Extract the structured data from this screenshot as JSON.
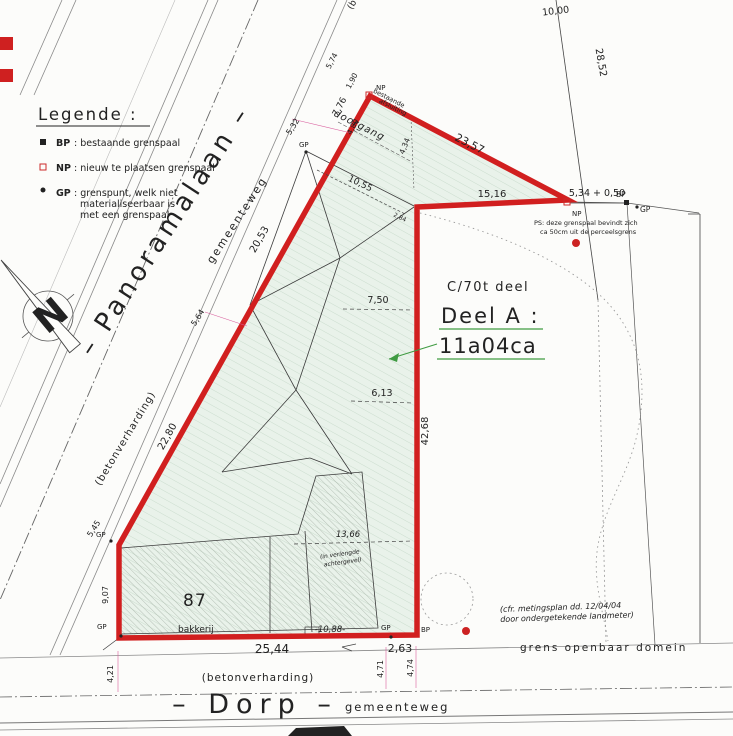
{
  "legend": {
    "title": "Legende :",
    "items": [
      {
        "code": "BP",
        "desc": ": bestaande grenspaal"
      },
      {
        "code": "NP",
        "desc": ": nieuw te plaatsen grenspaal"
      },
      {
        "code": "GP",
        "desc": ": grenspunt, welk niet",
        "desc2": "materialiseerbaar is",
        "desc3": "met een grenspaal"
      }
    ]
  },
  "compass": {
    "north": "N"
  },
  "roads": {
    "panoramalaan": {
      "name": "– Panoramalaan –",
      "type": "gemeenteweg",
      "surface": "(betonverharding)"
    },
    "dorp": {
      "name": "–  Dorp  –",
      "type": "gemeenteweg",
      "surface": "(betonverharding)"
    },
    "fragment": "(b"
  },
  "parcel": {
    "code": "C/70t deel",
    "name": "Deel A :",
    "area": "11a04ca",
    "building_number": "87",
    "building_use": "bakkerij",
    "passage_label": "doorgang",
    "fence_line1": "bestaande",
    "fence_line2": "afsluiting",
    "facade_note1": "(in verlengde",
    "facade_note2": "achtergevel)"
  },
  "notes": {
    "ps1": "PS: deze grenspaal bevindt zich",
    "ps2": "ca 50cm uit de perceelsgrens",
    "survey1": "(cfr. metingsplan dd. 12/04/04",
    "survey2": "door ondergetekende landmeter)",
    "public_domain": "grens openbaar domein"
  },
  "markers": {
    "bp": "BP",
    "np": "NP",
    "gp": "GP"
  },
  "dims": {
    "d5_74": "5,74",
    "d1_90": "1,90",
    "d7_76": "7,76",
    "d4_80": "4,80",
    "d4_34": "4,34",
    "d5_32": "5,32",
    "d20_53": "20,53",
    "d5_64": "5,64",
    "d22_80": "22,80",
    "d5_45": "5,45",
    "d9_07": "9,07",
    "d23_57": "23,57",
    "d10_55": "10,55",
    "d2_84": "2,84",
    "d15_16": "15,16",
    "d5_34": "5,34 + 0,50",
    "d28_52": "28,52",
    "d10_00": "10,00",
    "d7_50": "7,50",
    "d6_13": "6,13",
    "d42_68": "42,68",
    "d13_66": "13,66",
    "d10_88": "-10,88-",
    "d25_44": "25,44",
    "d2_63": "2,63",
    "d4_21": "4,21",
    "d4_71": "4,71",
    "d4_74": "4,74"
  },
  "colors": {
    "boundary_red": "#d11f1f",
    "dim_magenta": "#d95f9e",
    "parcel_green": "#3f9b42",
    "note_red": "#cc2a2a",
    "olive": "#9b8b2f"
  }
}
